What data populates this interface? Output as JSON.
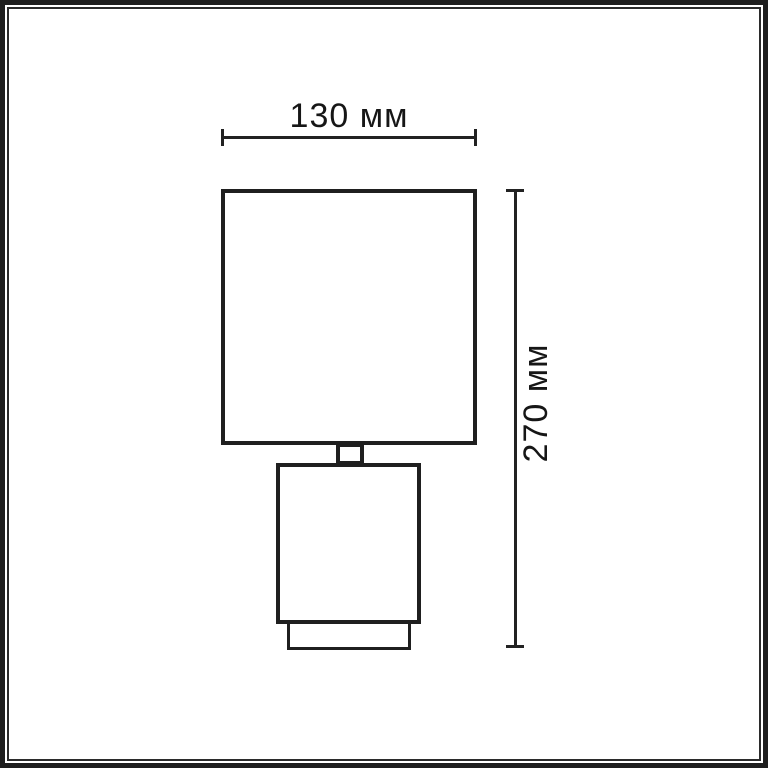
{
  "page": {
    "background": "#ffffff",
    "frame_color": "#1e1e1e",
    "stroke_color": "#1f1f1f",
    "text_color": "#161616"
  },
  "diagram": {
    "type": "dimension-drawing",
    "subject": "table-lamp-front-view",
    "parts": [
      "lamp-shade",
      "lamp-neck",
      "lamp-body",
      "lamp-foot"
    ],
    "dimensions": {
      "width": {
        "label": "130 мм",
        "value": 130,
        "unit": "мм",
        "orientation": "horizontal"
      },
      "height": {
        "label": "270 мм",
        "value": 270,
        "unit": "мм",
        "orientation": "vertical"
      }
    }
  }
}
